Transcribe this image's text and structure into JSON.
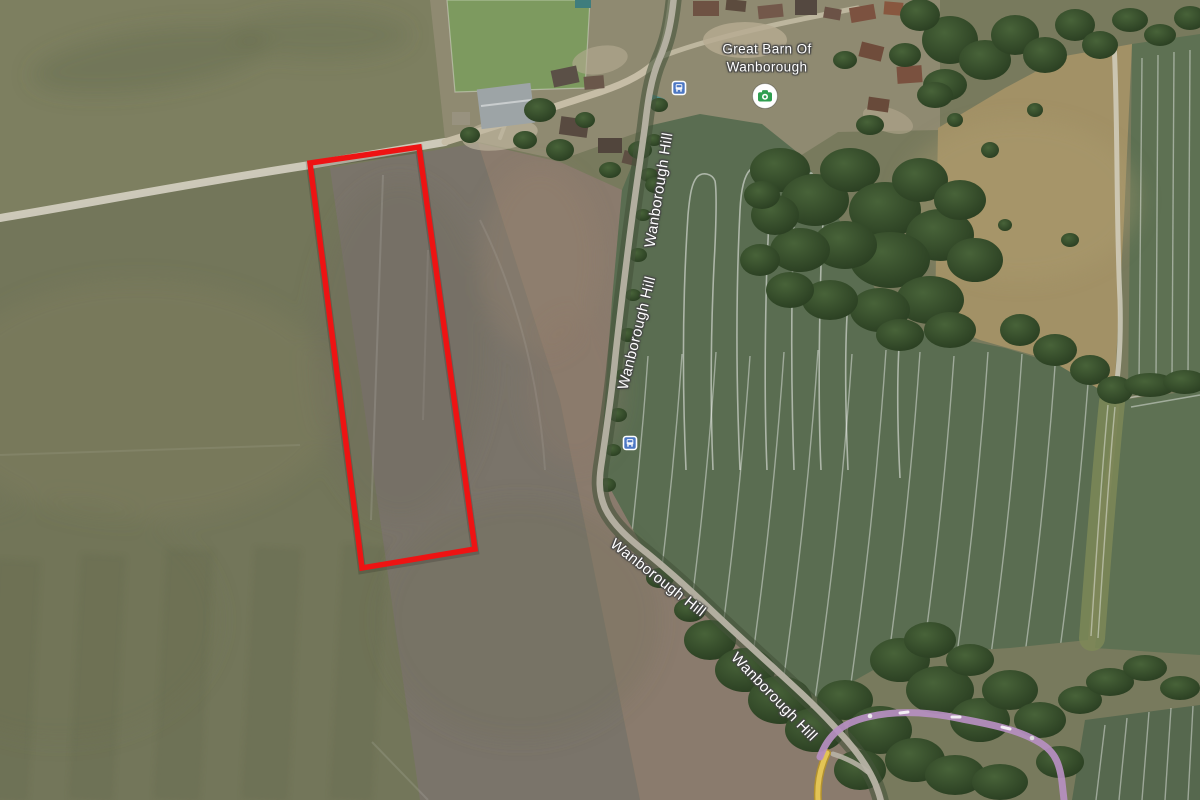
{
  "map": {
    "kind": "satellite-map",
    "poi": {
      "name_line1": "Great Barn Of",
      "name_line2": "Wanborough",
      "icon": "attraction-camera-icon"
    },
    "road": {
      "name": "Wanborough Hill",
      "visible_label_count": 4
    },
    "transit": {
      "icon": "bus-stop-icon",
      "visible_stop_count": 2
    },
    "overlay": {
      "shape": "parcel-quadrilateral",
      "outline_color": "#ee1313"
    },
    "colors": {
      "field_olive": "#787a5d",
      "field_olive_light": "#7d7f60",
      "field_left": "#73765a",
      "field_gray_brown": "#7a746a",
      "field_pink_brown": "#8a7b6d",
      "village_tan": "#8f8a71",
      "crop_green": "#5a6d51",
      "crop_green_right": "#5e7153",
      "crop_green_dark": "#56684e",
      "headland_green": "#7e8a58",
      "paddock_tan": "#a29166",
      "paddock_green": "#7d9a5f",
      "tree_dark": "#283c20",
      "tree_light": "#486339",
      "track_chalk": "#d6d2c3",
      "lane_tan": "#c6bda6",
      "road_gray": "#b7b3a5",
      "hedge_dark": "#44543a",
      "purple_road": "#b78fc2",
      "yellow_road": "#e3c455",
      "yellow_road_edge": "#b2912f",
      "parcel_red": "#ee1313",
      "bus_blue": "#4d78c4",
      "poi_green": "#2f9e4f",
      "label_white": "#ffffff",
      "label_halo": "#454545"
    }
  }
}
